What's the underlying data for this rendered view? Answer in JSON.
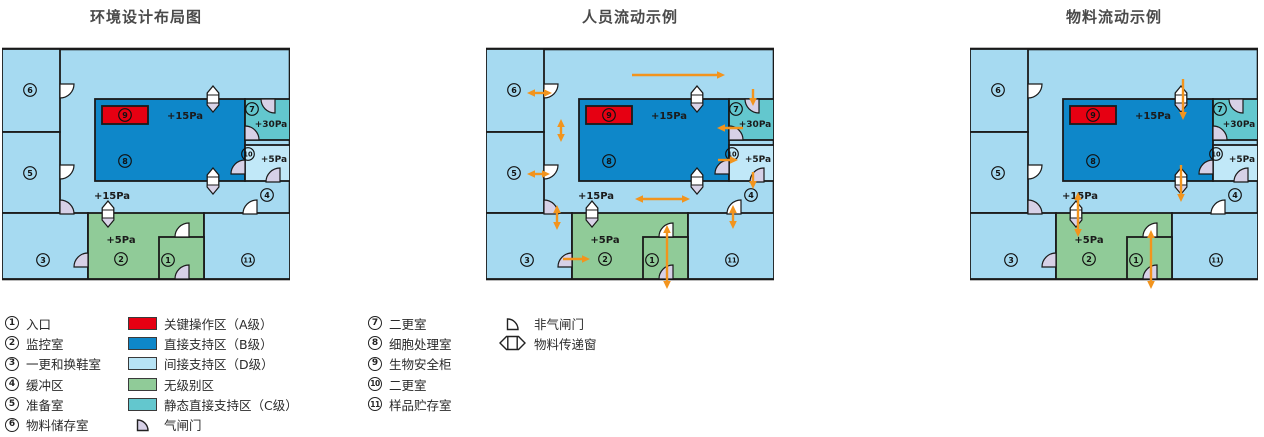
{
  "titles": [
    {
      "text": "环境设计布局图"
    },
    {
      "text": "人员流动示例"
    },
    {
      "text": "物料流动示例"
    }
  ],
  "colors": {
    "bg_indirect": "#a6daf1",
    "room10_fill": "#c1e8f8",
    "direct_b": "#0e87c9",
    "static_c": "#63c7ce",
    "unclassified": "#90cb98",
    "critical_a": "#e60012",
    "indirect_d_swatch": "#b7e4f6",
    "airlock_door": "#d7d1e7",
    "plain_door": "#ffffff",
    "window_shade": "#d9d3e8",
    "wall": "#1a1a1a",
    "arrow": "#f2941d"
  },
  "plan": {
    "w": 288,
    "h": 230,
    "rooms": [
      {
        "name": "base",
        "x": 0,
        "y": 0,
        "w": 288,
        "h": 230,
        "fill": "bg_indirect",
        "sw": 2.6
      },
      {
        "name": "room-6",
        "x": 0,
        "y": 0,
        "w": 58,
        "h": 83,
        "fill": "bg_indirect"
      },
      {
        "name": "room-5",
        "x": 0,
        "y": 83,
        "w": 58,
        "h": 81,
        "fill": "bg_indirect"
      },
      {
        "name": "room-3",
        "x": 0,
        "y": 164,
        "w": 86,
        "h": 66,
        "fill": "bg_indirect"
      },
      {
        "name": "room-2",
        "x": 86,
        "y": 164,
        "w": 116,
        "h": 66,
        "fill": "unclassified"
      },
      {
        "name": "room-11",
        "x": 202,
        "y": 164,
        "w": 86,
        "h": 66,
        "fill": "bg_indirect"
      },
      {
        "name": "room-8",
        "x": 93,
        "y": 50,
        "w": 150,
        "h": 82,
        "fill": "direct_b"
      },
      {
        "name": "room-7",
        "x": 243,
        "y": 50,
        "w": 45,
        "h": 41,
        "fill": "static_c"
      },
      {
        "name": "room-10",
        "x": 243,
        "y": 96,
        "w": 45,
        "h": 36,
        "fill": "room10_fill"
      },
      {
        "name": "room-1",
        "x": 157,
        "y": 188,
        "w": 45,
        "h": 42,
        "fill": "unclassified"
      },
      {
        "name": "biosafety-cabinet-9",
        "x": 100,
        "y": 57,
        "w": 46,
        "h": 18,
        "fill": "critical_a"
      }
    ],
    "labels": [
      {
        "n": "1",
        "x": 166,
        "y": 211
      },
      {
        "n": "2",
        "x": 119,
        "y": 210
      },
      {
        "n": "3",
        "x": 41,
        "y": 211
      },
      {
        "n": "4",
        "x": 265,
        "y": 146
      },
      {
        "n": "5",
        "x": 28,
        "y": 124
      },
      {
        "n": "6",
        "x": 28,
        "y": 41
      },
      {
        "n": "7",
        "x": 250,
        "y": 60
      },
      {
        "n": "8",
        "x": 123,
        "y": 112
      },
      {
        "n": "9",
        "x": 123,
        "y": 66
      },
      {
        "n": "10",
        "x": 246,
        "y": 105
      },
      {
        "n": "11",
        "x": 246,
        "y": 211
      }
    ],
    "pressures": [
      {
        "t": "+15Pa",
        "x": 183,
        "y": 70,
        "s": 10
      },
      {
        "t": "+30Pa",
        "x": 269,
        "y": 78,
        "s": 9
      },
      {
        "t": "+5Pa",
        "x": 272,
        "y": 113,
        "s": 9
      },
      {
        "t": "+15Pa",
        "x": 110,
        "y": 150,
        "s": 10
      },
      {
        "t": "+5Pa",
        "x": 119,
        "y": 194,
        "s": 10
      }
    ],
    "doors": [
      {
        "h": [
          58,
          35
        ],
        "d": [
          "e",
          "s"
        ],
        "t": "plain"
      },
      {
        "h": [
          58,
          116
        ],
        "d": [
          "e",
          "s"
        ],
        "t": "plain"
      },
      {
        "h": [
          58,
          165
        ],
        "d": [
          "n",
          "e"
        ],
        "t": "airlock"
      },
      {
        "h": [
          86,
          218
        ],
        "d": [
          "n",
          "w"
        ],
        "t": "airlock"
      },
      {
        "h": [
          187,
          188
        ],
        "d": [
          "n",
          "w"
        ],
        "t": "plain"
      },
      {
        "h": [
          187,
          230
        ],
        "d": [
          "n",
          "w"
        ],
        "t": "airlock"
      },
      {
        "h": [
          255,
          165
        ],
        "d": [
          "n",
          "w"
        ],
        "t": "plain"
      },
      {
        "h": [
          273,
          50
        ],
        "d": [
          "s",
          "w"
        ],
        "t": "airlock"
      },
      {
        "h": [
          243,
          91
        ],
        "d": [
          "n",
          "e"
        ],
        "t": "airlock"
      },
      {
        "h": [
          243,
          125
        ],
        "d": [
          "n",
          "w"
        ],
        "t": "airlock"
      },
      {
        "h": [
          278,
          133
        ],
        "d": [
          "n",
          "w"
        ],
        "t": "airlock"
      }
    ],
    "windows": [
      {
        "x": 211,
        "y": 50
      },
      {
        "x": 211,
        "y": 132
      },
      {
        "x": 106,
        "y": 165
      }
    ]
  },
  "flows": {
    "layout": [],
    "personnel": [
      {
        "p": [
          146,
          26,
          239,
          26
        ],
        "heads": "end"
      },
      {
        "p": [
          41,
          44,
          66,
          44
        ],
        "heads": "both"
      },
      {
        "p": [
          75,
          70,
          75,
          93
        ],
        "heads": "both"
      },
      {
        "p": [
          267,
          40,
          267,
          57
        ],
        "heads": "end"
      },
      {
        "p": [
          257,
          79,
          231,
          79
        ],
        "heads": "end"
      },
      {
        "p": [
          232,
          111,
          252,
          111
        ],
        "heads": "end"
      },
      {
        "p": [
          267,
          123,
          267,
          140
        ],
        "heads": "end"
      },
      {
        "p": [
          149,
          150,
          204,
          150
        ],
        "heads": "both"
      },
      {
        "p": [
          41,
          125,
          64,
          125
        ],
        "heads": "both"
      },
      {
        "p": [
          71,
          156,
          71,
          181
        ],
        "heads": "both"
      },
      {
        "p": [
          247,
          156,
          247,
          180
        ],
        "heads": "both"
      },
      {
        "p": [
          77,
          210,
          104,
          210
        ],
        "heads": "end"
      },
      {
        "p": [
          181,
          176,
          181,
          240
        ],
        "heads": "both"
      }
    ],
    "material": [
      {
        "p": [
          213,
          30,
          213,
          71
        ],
        "heads": "end"
      },
      {
        "p": [
          211,
          116,
          211,
          153
        ],
        "heads": "end"
      },
      {
        "p": [
          108,
          143,
          108,
          188
        ],
        "heads": "both"
      },
      {
        "p": [
          181,
          181,
          181,
          240
        ],
        "heads": "both"
      }
    ]
  },
  "legend": {
    "rooms_col1": [
      {
        "n": "1",
        "label": "入口"
      },
      {
        "n": "2",
        "label": "监控室"
      },
      {
        "n": "3",
        "label": "一更和换鞋室"
      },
      {
        "n": "4",
        "label": "缓冲区"
      },
      {
        "n": "5",
        "label": "准备室"
      },
      {
        "n": "6",
        "label": "物料储存室"
      }
    ],
    "zones": [
      {
        "swatch": "critical_a",
        "label": "关键操作区（A级）"
      },
      {
        "swatch": "direct_b",
        "label": "直接支持区（B级）"
      },
      {
        "swatch": "indirect_d_swatch",
        "label": "间接支持区（D级）"
      },
      {
        "swatch": "unclassified",
        "label": "无级别区"
      },
      {
        "swatch": "static_c",
        "label": "静态直接支持区（C级）"
      },
      {
        "icon": "airlock-door",
        "label": "气闸门"
      }
    ],
    "rooms_col3": [
      {
        "n": "7",
        "label": "二更室"
      },
      {
        "n": "8",
        "label": "细胞处理室"
      },
      {
        "n": "9",
        "label": "生物安全柜"
      },
      {
        "n": "10",
        "label": "二更室"
      },
      {
        "n": "11",
        "label": "样品贮存室"
      }
    ],
    "symbols": [
      {
        "icon": "plain-door",
        "label": "非气闸门"
      },
      {
        "icon": "pass-window",
        "label": "物料传递窗"
      }
    ]
  }
}
